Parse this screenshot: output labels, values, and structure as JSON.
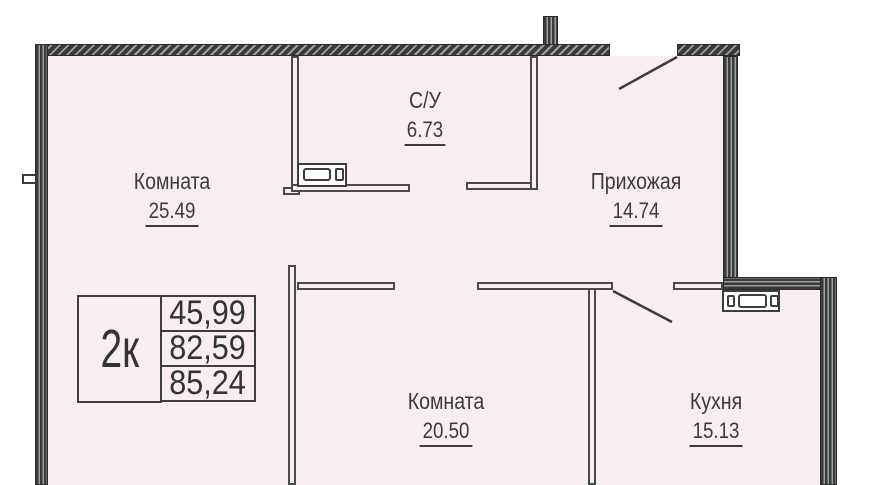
{
  "floorplan": {
    "rooms": [
      {
        "name": "Комната",
        "area": "25.49"
      },
      {
        "name": "С/У",
        "area": "6.73"
      },
      {
        "name": "Прихожая",
        "area": "14.74"
      },
      {
        "name": "Комната",
        "area": "20.50"
      },
      {
        "name": "Кухня",
        "area": "15.13"
      }
    ],
    "legend": {
      "type": "2к",
      "areas": [
        "45,99",
        "82,59",
        "85,24"
      ]
    },
    "colors": {
      "floor": "#f8eef0",
      "wall": "#3a3a3a",
      "text": "#3b3b3b"
    }
  }
}
